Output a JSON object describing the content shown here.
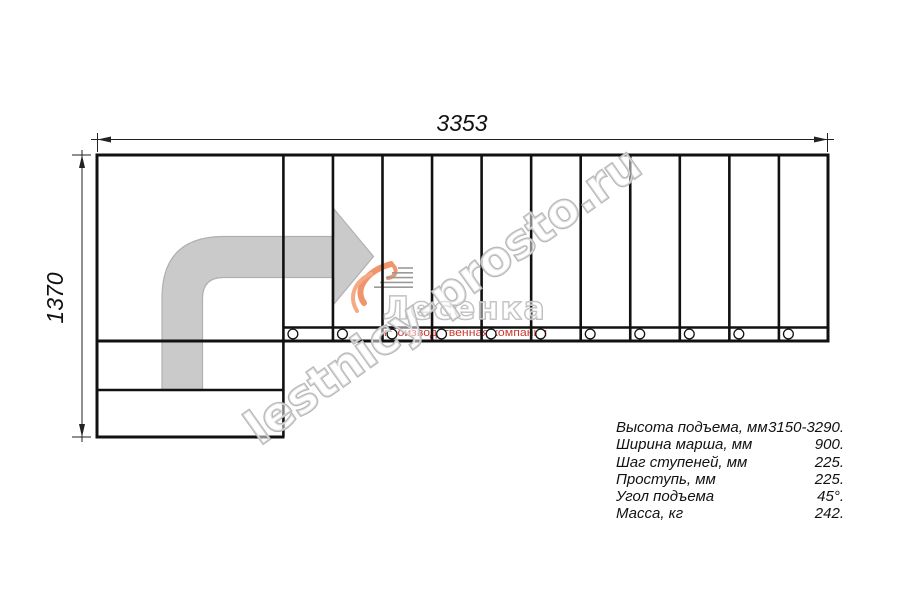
{
  "diagram": {
    "dimension_width_mm": "3353",
    "dimension_height_mm": "1370",
    "step_columns": 11,
    "tread_circles": 11
  },
  "watermark": {
    "site_text": "lestnicy-prosto.ru"
  },
  "logo": {
    "name": "Лесенка",
    "tagline": "производственная компания"
  },
  "specs": {
    "rows": [
      {
        "label": "Высота подъема, мм",
        "value": "3150-3290."
      },
      {
        "label": "Ширина марша, мм",
        "value": "900."
      },
      {
        "label": "Шаг ступеней, мм",
        "value": "225."
      },
      {
        "label": "Проступь, мм",
        "value": "225."
      },
      {
        "label": "Угол подъема",
        "value": "45°."
      },
      {
        "label": "Масса, кг",
        "value": "242."
      }
    ]
  },
  "colors": {
    "line": "#111111",
    "arrow_fill": "#cacaca",
    "arrow_stroke": "#b0b0b0",
    "watermark_gray": "#b5b5b5",
    "logo_orange": "#f0956b",
    "tagline_red": "#c9392e"
  }
}
